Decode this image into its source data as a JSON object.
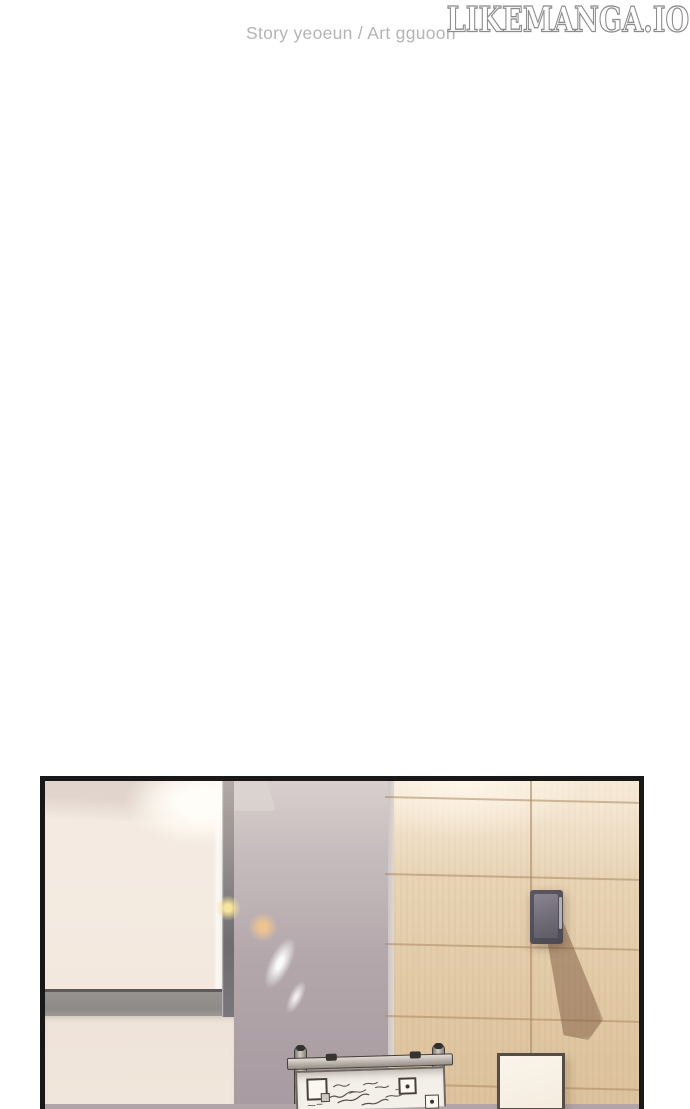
{
  "header": {
    "credits": "Story yeoeun / Art gguoon",
    "logo_text": "LikeManga.Io"
  },
  "scene": {
    "description": "manhwa interior panel: office corner with bright window light",
    "objects": [
      "window-screen",
      "window-frame",
      "ceiling-lamp-shade",
      "lens-flares",
      "mauve-wall",
      "wood-panel-wall",
      "wall-mounted-speaker",
      "speaker-shadow",
      "flipchart-whiteboard",
      "whiteboard-stand-posts",
      "sticky-notes",
      "illegible-handwriting",
      "paper-sheet-on-wall"
    ]
  },
  "colors": {
    "page_bg": "#ffffff",
    "credits_text": "#b4b4b4",
    "logo_outline": "#8c8c8c",
    "panel_border": "#181818",
    "window_cream": "#f3eae1",
    "frame_gray": "#8f8b88",
    "wall_mauve": "#b1a5a9",
    "wood_tan": "#e4cca9",
    "wood_grid_line": "#c3a986",
    "speaker_gray": "#5a5660",
    "shadow_brown": "#7d5a42",
    "paper_white": "#f8f1e6",
    "whiteboard_white": "#f3efe9",
    "flare_yellow": "#f6e096",
    "flare_orange": "#ecc290"
  }
}
